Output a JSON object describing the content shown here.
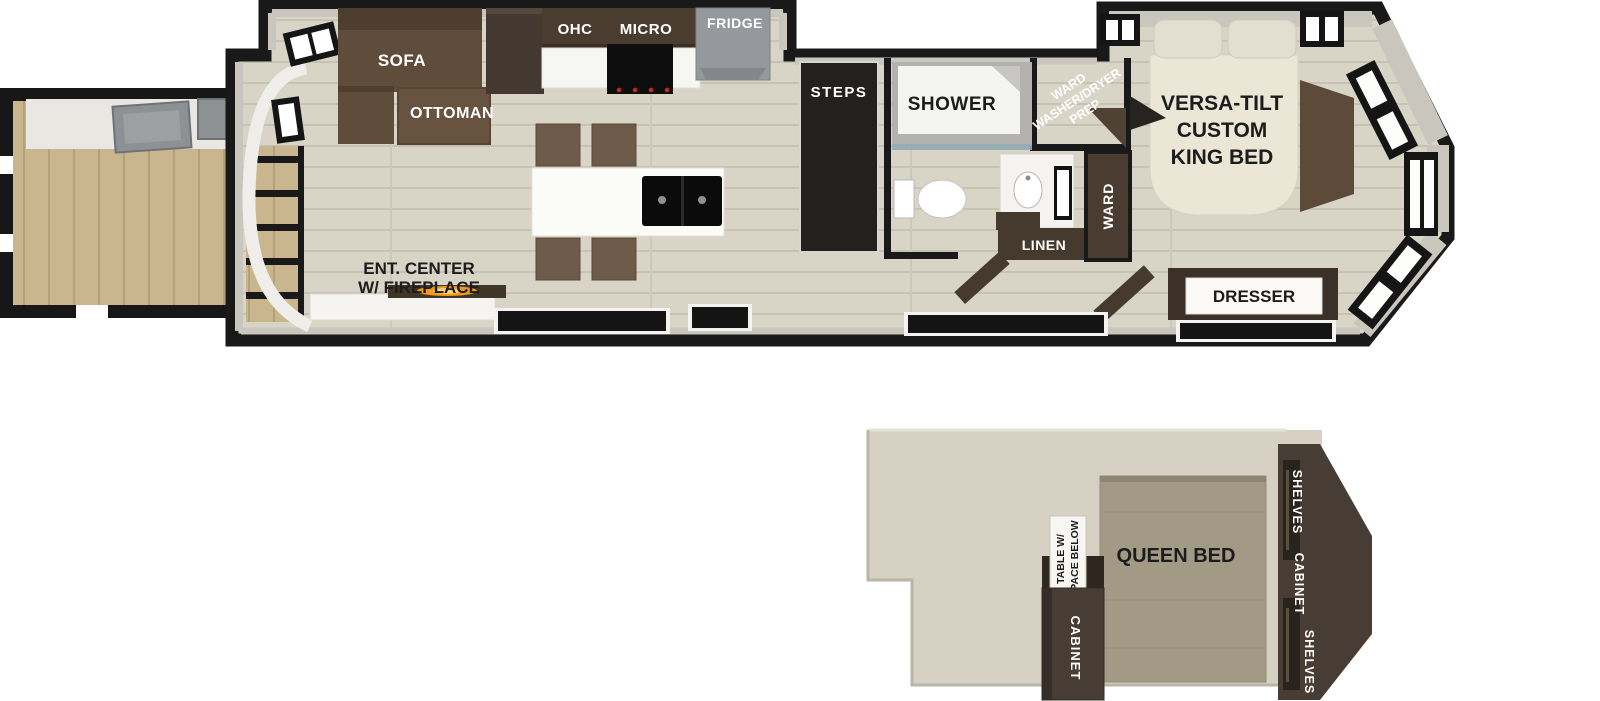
{
  "main": {
    "sofa": "SOFA",
    "ottoman": "OTTOMAN",
    "ohc": "OHC",
    "micro": "MICRO",
    "fridge": "FRIDGE",
    "steps": "STEPS",
    "shower": "SHOWER",
    "washer_dryer": {
      "line1": "WARD",
      "line2": "WASHER/DRYER",
      "line3": "PREP"
    },
    "king_bed": {
      "line1": "VERSA-TILT",
      "line2": "CUSTOM",
      "line3": "KING BED"
    },
    "linen": "LINEN",
    "ward": "WARD",
    "dresser": "DRESSER",
    "ent_center": {
      "line1": "ENT. CENTER",
      "line2": "W/ FIREPLACE"
    }
  },
  "loft": {
    "table": {
      "line1": "TABLE W/",
      "line2": "SPACE BELOW"
    },
    "queen_bed": "QUEEN BED",
    "cabinet": "CABINET",
    "right_unit": {
      "shelves_top": "SHELVES",
      "cabinet": "CABINET",
      "shelves_bottom": "SHELVES"
    }
  },
  "colors": {
    "wall_black": "#191919",
    "wall_gray": "#c9c6bd",
    "floor": "#d8d4c6",
    "deck_wood": "#c9b68f",
    "cabinet_brown": "#463c33",
    "sofa_brown": "#5f4c3b",
    "fridge_gray": "#95989c",
    "king_bed_cream": "#ebe6d5",
    "queen_bed_tan": "#a39a86",
    "loft_floor": "#d6d1c3",
    "fireplace_glow": "#f29a18"
  }
}
